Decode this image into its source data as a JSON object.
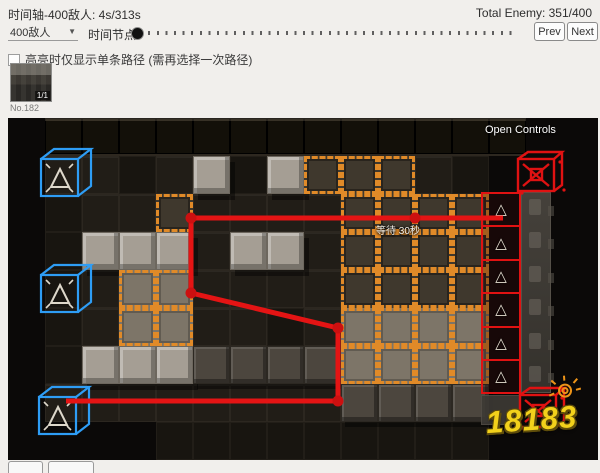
{
  "header": {
    "timeline_label": "时间轴-400敌人: 4s/313s",
    "total_enemy_label": "Total Enemy: 351/400",
    "enemy_select_value": "400敌人",
    "time_node_label": "时间节点:",
    "prev_label": "Prev",
    "next_label": "Next",
    "highlight_checkbox_label": "高亮时仅显示单条路径 (需再选择一次路径)",
    "checkbox_checked": false
  },
  "map_selector": {
    "badge": "1/1",
    "caption": "No.182"
  },
  "map": {
    "open_controls_label": "Open Controls",
    "wait_label": "等待 30秒",
    "watermark": "18183",
    "tile_size": {
      "w": 37,
      "h": 38
    },
    "tile_rows": [
      "krrrrrrrrrrrrrkk",
      "k..,.g,gooo.,kkk",
      "k,..o....ooookkk",
      "k,ggg.gg.ooookkk",
      "k,.OO....ooookkk",
      "k,.OO..,.OOOOkkk",
      "k,gggddddOOOOkkk",
      "k........ddddkkk",
      "kkkk,,,,,,,,,kkk"
    ],
    "colors": {
      "path_red": "#e41414",
      "node_red": "#cc1010",
      "spawn_red": "#e01212",
      "protect_blue": "#2e9df5",
      "orange_dashed": "#e08a28",
      "triangle_pale": "#ded8cb"
    },
    "path": {
      "points": [
        [
          495,
          100
        ],
        [
          183,
          100
        ],
        [
          183,
          175
        ],
        [
          330,
          210
        ],
        [
          330,
          283
        ],
        [
          58,
          283
        ]
      ],
      "nodes": [
        [
          407,
          100
        ],
        [
          183,
          100
        ],
        [
          183,
          175
        ],
        [
          330,
          210
        ],
        [
          330,
          283
        ]
      ]
    },
    "blue_cubes": [
      {
        "x": 30,
        "y": 28
      },
      {
        "x": 30,
        "y": 144
      },
      {
        "x": 28,
        "y": 266
      }
    ],
    "red_cubes": [
      {
        "x": 506,
        "y": 32
      },
      {
        "x": 508,
        "y": 268
      }
    ],
    "red_spawn_cells": {
      "x": 473,
      "y": 74,
      "w": 40,
      "h": 33.4,
      "count": 6
    },
    "ghost_strip": {
      "x": 513,
      "y": 74,
      "w": 30,
      "h": 201,
      "icons": 6
    },
    "ghost_cell_bottom": {
      "x": 473,
      "y": 277,
      "w": 40,
      "h": 30
    }
  }
}
